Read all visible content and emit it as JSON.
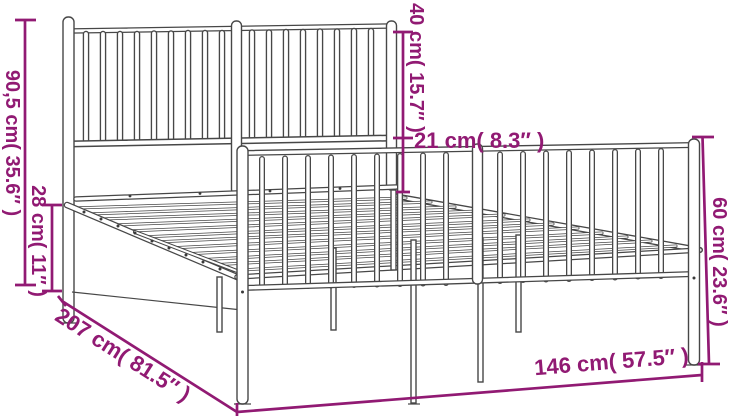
{
  "diagram": {
    "type": "product-dimension-diagram",
    "product": "metal bed frame with headboard and footboard",
    "colors": {
      "accent": "#911a73",
      "line": "#474747",
      "bg": "#ffffff"
    },
    "dimensions": {
      "overall_height": {
        "label": "90,5 cm( 35.6″ )"
      },
      "platform_height": {
        "label": "28 cm( 11″ )"
      },
      "headboard_top": {
        "label": "40 cm( 15.7″ )"
      },
      "headboard_gap": {
        "label": "21 cm( 8.3″ )"
      },
      "footboard_height": {
        "label": "60 cm( 23.6″ )"
      },
      "length": {
        "label": "207 cm( 81.5″ )"
      },
      "width": {
        "label": "146 cm( 57.5″ )"
      }
    }
  }
}
